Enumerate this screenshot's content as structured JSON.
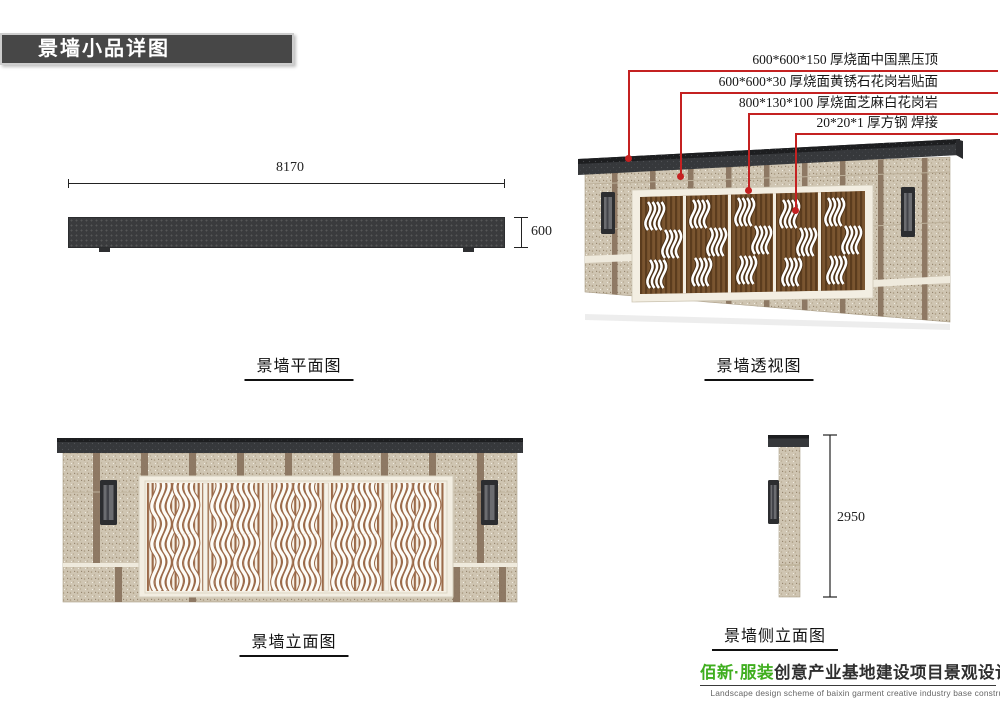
{
  "header": {
    "title": "景墙小品详图"
  },
  "annotations": [
    {
      "label": "600*600*150 厚烧面中国黑压顶"
    },
    {
      "label": "600*600*30 厚烧面黄锈石花岗岩贴面"
    },
    {
      "label": "800*130*100 厚烧面芝麻白花岗岩"
    },
    {
      "label": "20*20*1 厚方钢 焊接"
    }
  ],
  "views": {
    "plan": {
      "caption": "景墙平面图",
      "dims": {
        "length": "8170",
        "depth": "600"
      }
    },
    "perspective": {
      "caption": "景墙透视图"
    },
    "elevation": {
      "caption": "景墙立面图"
    },
    "side": {
      "caption": "景墙侧立面图",
      "dims": {
        "height": "2950"
      }
    }
  },
  "footer": {
    "brand_zh": "佰新·服装",
    "title_zh": "创意产业基地建设项目景观设计方案",
    "title_en": "Landscape design scheme of baixin garment creative industry base construction project"
  },
  "colors": {
    "annotation_red": "#c42121",
    "footer_green": "#3fae1e",
    "stone_beige": "#cfc5b2",
    "stone_strip_brown": "#8b7560",
    "cap_dark": "#36383b",
    "wood_brown": "#7a5530",
    "panel_cream": "#f6f1e6",
    "panel_slat_brown": "#9b6a49"
  }
}
